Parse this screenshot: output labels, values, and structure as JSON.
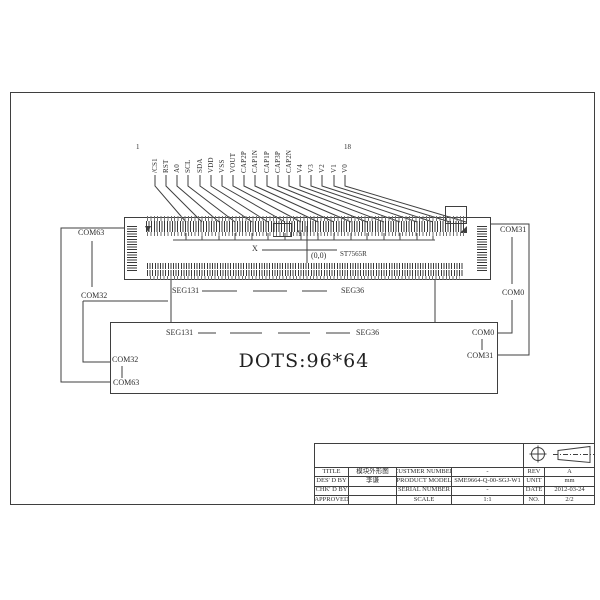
{
  "page": {
    "background": "#ffffff",
    "line_color": "#3f3f3f",
    "text_color": "#2f2f2f"
  },
  "drawing": {
    "first_pin_number": "1",
    "last_pin_number": "18",
    "pins": [
      "/CS1",
      "RST",
      "A0",
      "SCL",
      "SDA",
      "VDD",
      "VSS",
      "VOUT",
      "CAP2P",
      "CAP1N",
      "CAP1P",
      "CAP3P",
      "CAP2N",
      "V4",
      "V3",
      "V2",
      "V1",
      "V0"
    ],
    "axis": {
      "x": "X",
      "y": "Y",
      "origin": "(0,0)"
    },
    "controller": "ST7565R",
    "left": {
      "top": "COM63",
      "bottom": "COM32"
    },
    "right": {
      "top": "COM31",
      "bottom": "COM0"
    },
    "seg_row": {
      "left": "SEG131",
      "right": "SEG36"
    },
    "panel": {
      "seg_left": "SEG131",
      "seg_right": "SEG36",
      "com_right_top": "COM0",
      "com_right_bottom": "COM31",
      "com_left_top": "COM32",
      "com_left_bottom": "COM63",
      "dots": "DOTS:96*64"
    }
  },
  "title_block": {
    "rows": [
      {
        "l1": "TITLE",
        "v1": "模块外形图",
        "l2": "CUSTMER NUMBER",
        "v2": "-",
        "l3": "REV",
        "v3": "A"
      },
      {
        "l1": "DES' D BY",
        "v1": "李谦",
        "l2": "PRODUCT MODEL",
        "v2": "SME9664-Q-00-SGJ-W1",
        "l3": "UNIT",
        "v3": "mm"
      },
      {
        "l1": "CHK' D BY",
        "v1": "",
        "l2": "SERIAL NUMBER",
        "v2": "-",
        "l3": "DATE",
        "v3": "2012-03-24"
      },
      {
        "l1": "APPROVED",
        "v1": "",
        "l2": "SCALE",
        "v2": "1:1",
        "l3": "NO.",
        "v3": "2/2"
      }
    ]
  }
}
